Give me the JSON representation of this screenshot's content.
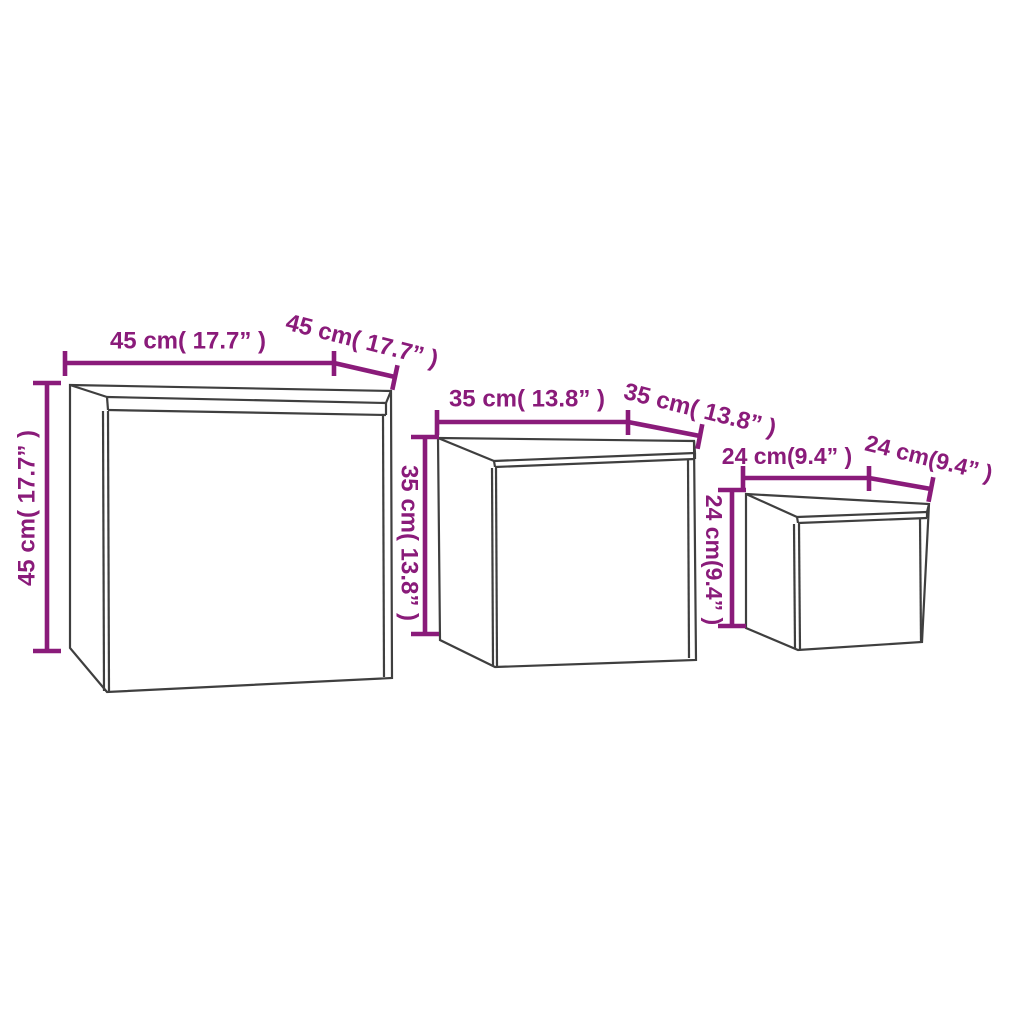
{
  "diagram": {
    "description_colors": {
      "dimension_accent": "#8a1b7a",
      "box_outline": "#3f3f3f",
      "background": "#ffffff"
    },
    "boxes": [
      {
        "width_label": "45 cm( 17.7” )",
        "depth_label": "45 cm( 17.7” )",
        "height_label": "45 cm( 17.7” )",
        "width_cm": 45,
        "depth_cm": 45,
        "height_cm": 45,
        "width_inch": 17.7,
        "depth_inch": 17.7,
        "height_inch": 17.7
      },
      {
        "width_label": "35 cm( 13.8” )",
        "depth_label": "35 cm( 13.8” )",
        "height_label": "35 cm( 13.8” )",
        "width_cm": 35,
        "depth_cm": 35,
        "height_cm": 35,
        "width_inch": 13.8,
        "depth_inch": 13.8,
        "height_inch": 13.8
      },
      {
        "width_label": "24 cm(9.4” )",
        "depth_label": "24 cm(9.4” )",
        "height_label": "24 cm(9.4” )",
        "width_cm": 24,
        "depth_cm": 24,
        "height_cm": 24,
        "width_inch": 9.4,
        "depth_inch": 9.4,
        "height_inch": 9.4
      }
    ]
  }
}
